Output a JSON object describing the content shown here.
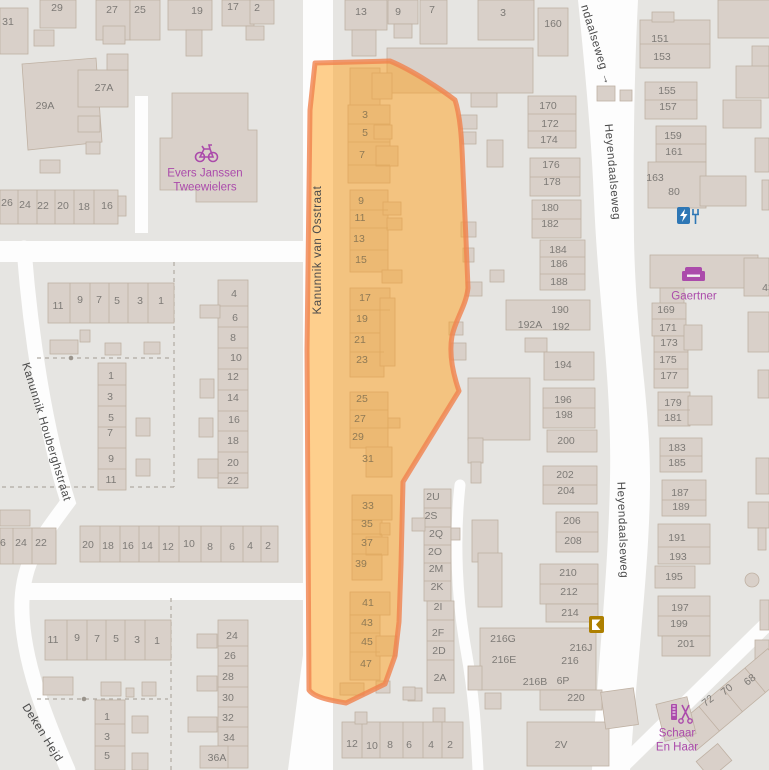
{
  "map": {
    "colors": {
      "background": "#e6e5e2",
      "road": "#fdfdfd",
      "building_fill": "#d9d0c9",
      "building_stroke": "#bfb1a3",
      "highlight_fill": "#ffa21e",
      "highlight_stroke": "#f0824d",
      "poi_purple": "#ab4bab",
      "charging_blue": "#2e77b5",
      "kiosk_gold": "#ad7f00",
      "street_text": "#4a4a4a",
      "housenumber_text": "#7d7a76"
    },
    "streets": [
      {
        "name": "Kanunnik van Osstraat",
        "x": 318,
        "y": 250,
        "rot": -90
      },
      {
        "name": "Kanunnik Houberghstraat",
        "x": 46,
        "y": 432,
        "rot": 73
      },
      {
        "name": "Deken Hejd",
        "x": 42,
        "y": 733,
        "rot": 58
      },
      {
        "name": "ndaalseweg →",
        "x": 596,
        "y": 45,
        "rot": 73
      },
      {
        "name": "Heyendaalseweg",
        "x": 612,
        "y": 172,
        "rot": 85
      },
      {
        "name": "Heyendaalseweg",
        "x": 622,
        "y": 530,
        "rot": 88
      }
    ],
    "pois": [
      {
        "name": "Evers Janssen Tweewielers",
        "lines": [
          "Evers Janssen",
          "Tweewielers"
        ],
        "icon": "bicycle-icon",
        "x": 205,
        "y": 181
      },
      {
        "name": "Gaertner",
        "lines": [
          "Gaertner"
        ],
        "icon": "sofa-icon",
        "x": 694,
        "y": 297
      },
      {
        "name": "Schaar En Haar",
        "lines": [
          "Schaar",
          "En Haar"
        ],
        "icon": "scissors-icon",
        "x": 677,
        "y": 741
      }
    ],
    "amenity_icons": [
      {
        "name": "charging-station-icon",
        "x": 684,
        "y": 215
      },
      {
        "name": "kiosk-icon",
        "x": 596,
        "y": 624
      }
    ],
    "house_numbers": [
      {
        "t": "31",
        "x": 8,
        "y": 22
      },
      {
        "t": "29",
        "x": 57,
        "y": 8
      },
      {
        "t": "27",
        "x": 112,
        "y": 10
      },
      {
        "t": "25",
        "x": 140,
        "y": 10
      },
      {
        "t": "19",
        "x": 197,
        "y": 11
      },
      {
        "t": "17",
        "x": 233,
        "y": 7
      },
      {
        "t": "2",
        "x": 257,
        "y": 8
      },
      {
        "t": "13",
        "x": 361,
        "y": 12
      },
      {
        "t": "9",
        "x": 398,
        "y": 12
      },
      {
        "t": "7",
        "x": 432,
        "y": 10
      },
      {
        "t": "3",
        "x": 503,
        "y": 13
      },
      {
        "t": "160",
        "x": 553,
        "y": 24
      },
      {
        "t": "151",
        "x": 660,
        "y": 39
      },
      {
        "t": "153",
        "x": 662,
        "y": 57
      },
      {
        "t": "155",
        "x": 667,
        "y": 91
      },
      {
        "t": "157",
        "x": 668,
        "y": 107
      },
      {
        "t": "159",
        "x": 673,
        "y": 136
      },
      {
        "t": "161",
        "x": 674,
        "y": 152
      },
      {
        "t": "163",
        "x": 655,
        "y": 178
      },
      {
        "t": "80",
        "x": 674,
        "y": 192
      },
      {
        "t": "29A",
        "x": 45,
        "y": 106
      },
      {
        "t": "27A",
        "x": 104,
        "y": 88
      },
      {
        "t": "26",
        "x": 7,
        "y": 203
      },
      {
        "t": "24",
        "x": 25,
        "y": 205
      },
      {
        "t": "22",
        "x": 43,
        "y": 206
      },
      {
        "t": "20",
        "x": 63,
        "y": 206
      },
      {
        "t": "18",
        "x": 84,
        "y": 207
      },
      {
        "t": "16",
        "x": 107,
        "y": 206
      },
      {
        "t": "11",
        "x": 58,
        "y": 306
      },
      {
        "t": "9",
        "x": 80,
        "y": 300
      },
      {
        "t": "7",
        "x": 99,
        "y": 300
      },
      {
        "t": "5",
        "x": 117,
        "y": 301
      },
      {
        "t": "3",
        "x": 140,
        "y": 301
      },
      {
        "t": "1",
        "x": 161,
        "y": 301
      },
      {
        "t": "1",
        "x": 111,
        "y": 376
      },
      {
        "t": "3",
        "x": 110,
        "y": 397
      },
      {
        "t": "5",
        "x": 111,
        "y": 418
      },
      {
        "t": "7",
        "x": 110,
        "y": 433
      },
      {
        "t": "9",
        "x": 111,
        "y": 459
      },
      {
        "t": "11",
        "x": 111,
        "y": 480
      },
      {
        "t": "4",
        "x": 234,
        "y": 294
      },
      {
        "t": "6",
        "x": 235,
        "y": 318
      },
      {
        "t": "8",
        "x": 233,
        "y": 338
      },
      {
        "t": "10",
        "x": 236,
        "y": 358
      },
      {
        "t": "12",
        "x": 233,
        "y": 377
      },
      {
        "t": "14",
        "x": 233,
        "y": 398
      },
      {
        "t": "16",
        "x": 234,
        "y": 420
      },
      {
        "t": "18",
        "x": 233,
        "y": 441
      },
      {
        "t": "20",
        "x": 233,
        "y": 463
      },
      {
        "t": "22",
        "x": 233,
        "y": 481
      },
      {
        "t": "26",
        "x": 0,
        "y": 543
      },
      {
        "t": "24",
        "x": 21,
        "y": 543
      },
      {
        "t": "22",
        "x": 41,
        "y": 543
      },
      {
        "t": "20",
        "x": 88,
        "y": 545
      },
      {
        "t": "18",
        "x": 108,
        "y": 546
      },
      {
        "t": "16",
        "x": 128,
        "y": 546
      },
      {
        "t": "14",
        "x": 147,
        "y": 546
      },
      {
        "t": "12",
        "x": 168,
        "y": 547
      },
      {
        "t": "10",
        "x": 189,
        "y": 544
      },
      {
        "t": "8",
        "x": 210,
        "y": 547
      },
      {
        "t": "6",
        "x": 232,
        "y": 547
      },
      {
        "t": "4",
        "x": 250,
        "y": 546
      },
      {
        "t": "2",
        "x": 268,
        "y": 546
      },
      {
        "t": "11",
        "x": 53,
        "y": 640
      },
      {
        "t": "9",
        "x": 77,
        "y": 638
      },
      {
        "t": "7",
        "x": 97,
        "y": 639
      },
      {
        "t": "5",
        "x": 116,
        "y": 639
      },
      {
        "t": "3",
        "x": 137,
        "y": 640
      },
      {
        "t": "1",
        "x": 157,
        "y": 641
      },
      {
        "t": "1",
        "x": 107,
        "y": 717
      },
      {
        "t": "3",
        "x": 107,
        "y": 737
      },
      {
        "t": "5",
        "x": 107,
        "y": 756
      },
      {
        "t": "24",
        "x": 232,
        "y": 636
      },
      {
        "t": "26",
        "x": 230,
        "y": 656
      },
      {
        "t": "28",
        "x": 228,
        "y": 677
      },
      {
        "t": "30",
        "x": 228,
        "y": 698
      },
      {
        "t": "32",
        "x": 228,
        "y": 718
      },
      {
        "t": "34",
        "x": 229,
        "y": 738
      },
      {
        "t": "36A",
        "x": 217,
        "y": 758
      },
      {
        "t": "3",
        "x": 365,
        "y": 115,
        "hl": 1
      },
      {
        "t": "5",
        "x": 365,
        "y": 133,
        "hl": 1
      },
      {
        "t": "7",
        "x": 362,
        "y": 155,
        "hl": 1
      },
      {
        "t": "9",
        "x": 361,
        "y": 201,
        "hl": 1
      },
      {
        "t": "11",
        "x": 360,
        "y": 218,
        "hl": 1
      },
      {
        "t": "13",
        "x": 359,
        "y": 239,
        "hl": 1
      },
      {
        "t": "15",
        "x": 361,
        "y": 260,
        "hl": 1
      },
      {
        "t": "17",
        "x": 365,
        "y": 298,
        "hl": 1
      },
      {
        "t": "19",
        "x": 362,
        "y": 319,
        "hl": 1
      },
      {
        "t": "21",
        "x": 360,
        "y": 340,
        "hl": 1
      },
      {
        "t": "23",
        "x": 362,
        "y": 360,
        "hl": 1
      },
      {
        "t": "25",
        "x": 362,
        "y": 399,
        "hl": 1
      },
      {
        "t": "27",
        "x": 360,
        "y": 419,
        "hl": 1
      },
      {
        "t": "29",
        "x": 358,
        "y": 437,
        "hl": 1
      },
      {
        "t": "31",
        "x": 368,
        "y": 459,
        "hl": 1
      },
      {
        "t": "33",
        "x": 368,
        "y": 506,
        "hl": 1
      },
      {
        "t": "35",
        "x": 367,
        "y": 524,
        "hl": 1
      },
      {
        "t": "37",
        "x": 367,
        "y": 543,
        "hl": 1
      },
      {
        "t": "39",
        "x": 361,
        "y": 564,
        "hl": 1
      },
      {
        "t": "41",
        "x": 368,
        "y": 603,
        "hl": 1
      },
      {
        "t": "43",
        "x": 367,
        "y": 623,
        "hl": 1
      },
      {
        "t": "45",
        "x": 367,
        "y": 642,
        "hl": 1
      },
      {
        "t": "47",
        "x": 366,
        "y": 664,
        "hl": 1
      },
      {
        "t": "2U",
        "x": 433,
        "y": 497
      },
      {
        "t": "2S",
        "x": 431,
        "y": 516
      },
      {
        "t": "2Q",
        "x": 436,
        "y": 534
      },
      {
        "t": "2O",
        "x": 435,
        "y": 552
      },
      {
        "t": "2M",
        "x": 436,
        "y": 569
      },
      {
        "t": "2K",
        "x": 437,
        "y": 587
      },
      {
        "t": "2I",
        "x": 438,
        "y": 607
      },
      {
        "t": "2F",
        "x": 438,
        "y": 633
      },
      {
        "t": "2D",
        "x": 439,
        "y": 651
      },
      {
        "t": "2A",
        "x": 440,
        "y": 678
      },
      {
        "t": "12",
        "x": 352,
        "y": 744
      },
      {
        "t": "10",
        "x": 372,
        "y": 746
      },
      {
        "t": "8",
        "x": 390,
        "y": 745
      },
      {
        "t": "6",
        "x": 409,
        "y": 745
      },
      {
        "t": "4",
        "x": 431,
        "y": 745
      },
      {
        "t": "2",
        "x": 450,
        "y": 745
      },
      {
        "t": "170",
        "x": 548,
        "y": 106
      },
      {
        "t": "172",
        "x": 550,
        "y": 124
      },
      {
        "t": "174",
        "x": 549,
        "y": 140
      },
      {
        "t": "176",
        "x": 551,
        "y": 165
      },
      {
        "t": "178",
        "x": 552,
        "y": 182
      },
      {
        "t": "180",
        "x": 550,
        "y": 208
      },
      {
        "t": "182",
        "x": 550,
        "y": 224
      },
      {
        "t": "184",
        "x": 558,
        "y": 250
      },
      {
        "t": "186",
        "x": 559,
        "y": 264
      },
      {
        "t": "188",
        "x": 559,
        "y": 282
      },
      {
        "t": "190",
        "x": 560,
        "y": 310
      },
      {
        "t": "192A",
        "x": 530,
        "y": 325
      },
      {
        "t": "192",
        "x": 561,
        "y": 327
      },
      {
        "t": "194",
        "x": 563,
        "y": 365
      },
      {
        "t": "196",
        "x": 563,
        "y": 400
      },
      {
        "t": "198",
        "x": 564,
        "y": 415
      },
      {
        "t": "200",
        "x": 566,
        "y": 441
      },
      {
        "t": "202",
        "x": 565,
        "y": 475
      },
      {
        "t": "204",
        "x": 566,
        "y": 491
      },
      {
        "t": "206",
        "x": 572,
        "y": 521
      },
      {
        "t": "208",
        "x": 573,
        "y": 541
      },
      {
        "t": "210",
        "x": 568,
        "y": 573
      },
      {
        "t": "212",
        "x": 569,
        "y": 592
      },
      {
        "t": "214",
        "x": 570,
        "y": 613
      },
      {
        "t": "216G",
        "x": 503,
        "y": 639
      },
      {
        "t": "216J",
        "x": 581,
        "y": 648
      },
      {
        "t": "216E",
        "x": 504,
        "y": 660
      },
      {
        "t": "216",
        "x": 570,
        "y": 661
      },
      {
        "t": "216B",
        "x": 535,
        "y": 682
      },
      {
        "t": "6P",
        "x": 563,
        "y": 681
      },
      {
        "t": "220",
        "x": 576,
        "y": 698
      },
      {
        "t": "2V",
        "x": 561,
        "y": 745
      },
      {
        "t": "169",
        "x": 666,
        "y": 310
      },
      {
        "t": "171",
        "x": 668,
        "y": 328
      },
      {
        "t": "173",
        "x": 669,
        "y": 343
      },
      {
        "t": "175",
        "x": 668,
        "y": 360
      },
      {
        "t": "177",
        "x": 669,
        "y": 376
      },
      {
        "t": "179",
        "x": 673,
        "y": 403
      },
      {
        "t": "181",
        "x": 673,
        "y": 418
      },
      {
        "t": "183",
        "x": 677,
        "y": 448
      },
      {
        "t": "185",
        "x": 677,
        "y": 463
      },
      {
        "t": "187",
        "x": 680,
        "y": 493
      },
      {
        "t": "189",
        "x": 681,
        "y": 507
      },
      {
        "t": "191",
        "x": 677,
        "y": 538
      },
      {
        "t": "193",
        "x": 678,
        "y": 557
      },
      {
        "t": "195",
        "x": 674,
        "y": 577
      },
      {
        "t": "197",
        "x": 680,
        "y": 608
      },
      {
        "t": "199",
        "x": 679,
        "y": 624
      },
      {
        "t": "201",
        "x": 686,
        "y": 644
      },
      {
        "t": "43",
        "x": 768,
        "y": 288
      },
      {
        "t": "68",
        "x": 750,
        "y": 680,
        "rot": -38
      },
      {
        "t": "70",
        "x": 727,
        "y": 690,
        "rot": -38
      },
      {
        "t": "72",
        "x": 708,
        "y": 701,
        "rot": -38
      }
    ]
  }
}
